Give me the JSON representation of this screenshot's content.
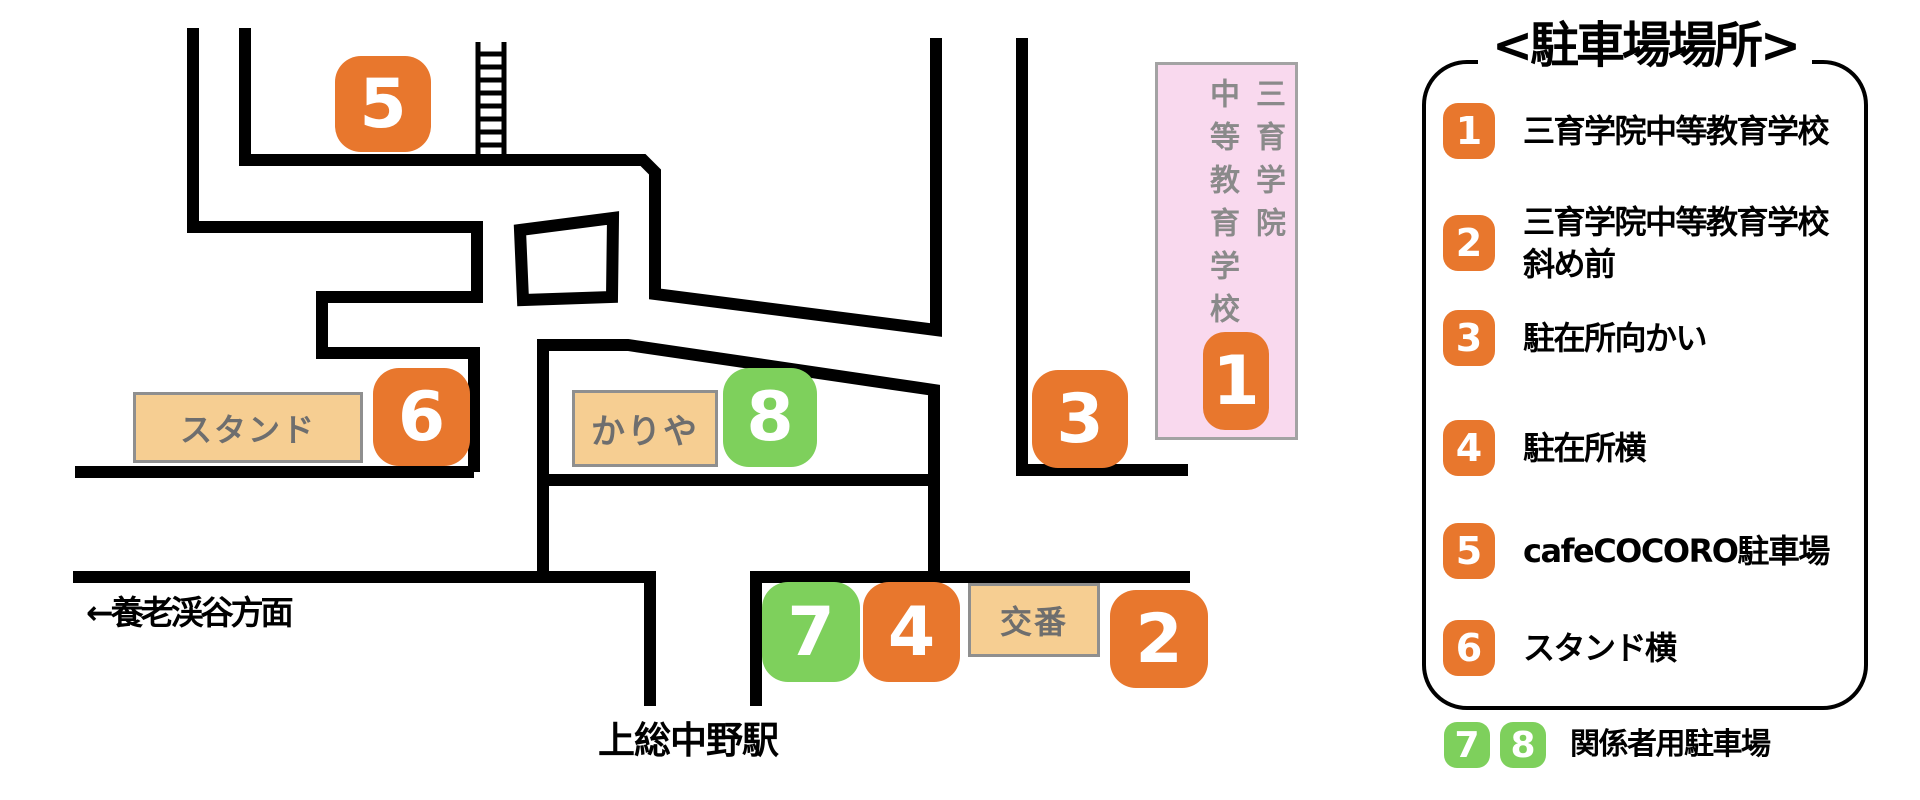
{
  "legend": {
    "title": "<駐車場場所>",
    "items": [
      {
        "num": "1",
        "label": "三育学院中等教育学校",
        "label2": ""
      },
      {
        "num": "2",
        "label": "三育学院中等教育学校",
        "label2": "斜め前"
      },
      {
        "num": "3",
        "label": "駐在所向かい",
        "label2": ""
      },
      {
        "num": "4",
        "label": "駐在所横",
        "label2": ""
      },
      {
        "num": "5",
        "label": "cafeCOCORO駐車場",
        "label2": ""
      },
      {
        "num": "6",
        "label": "スタンド横",
        "label2": ""
      }
    ],
    "note": {
      "num1": "7",
      "num2": "8",
      "label": "関係者用駐車場"
    }
  },
  "map": {
    "school": {
      "column_right": "三育学院",
      "column_left": "中等教育学校"
    },
    "buildings": {
      "stand": "スタンド",
      "kariya": "かりや",
      "koban": "交番"
    },
    "road_labels": {
      "yoro_direction": "←養老渓谷方面",
      "station": "上総中野駅"
    },
    "markers": [
      {
        "num": "1",
        "color": "orange"
      },
      {
        "num": "2",
        "color": "orange"
      },
      {
        "num": "3",
        "color": "orange"
      },
      {
        "num": "4",
        "color": "orange"
      },
      {
        "num": "5",
        "color": "orange"
      },
      {
        "num": "6",
        "color": "orange"
      },
      {
        "num": "7",
        "color": "green"
      },
      {
        "num": "8",
        "color": "green"
      }
    ]
  },
  "colors": {
    "marker_orange": "#E8772D",
    "marker_green": "#7ED05C",
    "building_beige": "#F6CE92",
    "school_pink": "#F9D9EE",
    "road_black": "#000000"
  }
}
